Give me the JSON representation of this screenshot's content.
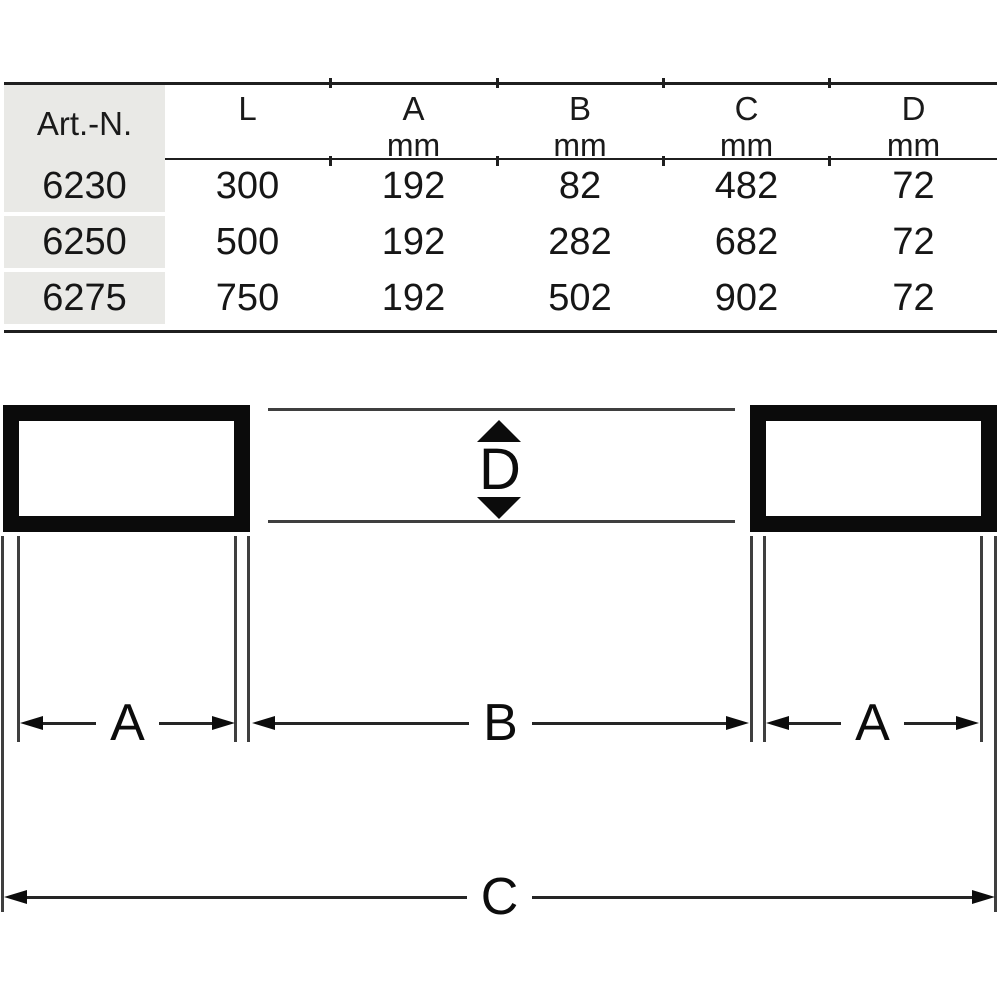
{
  "table": {
    "columns": [
      {
        "label": "Art.-N.",
        "unit": ""
      },
      {
        "label": "L",
        "unit": ""
      },
      {
        "label": "A",
        "unit": "mm"
      },
      {
        "label": "B",
        "unit": "mm"
      },
      {
        "label": "C",
        "unit": "mm"
      },
      {
        "label": "D",
        "unit": "mm"
      }
    ],
    "rows": [
      {
        "cells": [
          "6230",
          "300",
          "192",
          "82",
          "482",
          "72"
        ]
      },
      {
        "cells": [
          "6250",
          "500",
          "192",
          "282",
          "682",
          "72"
        ]
      },
      {
        "cells": [
          "6275",
          "750",
          "192",
          "502",
          "902",
          "72"
        ]
      }
    ]
  },
  "diagram": {
    "dim_d": "D",
    "dim_a_left": "A",
    "dim_b": "B",
    "dim_a_right": "A",
    "dim_c": "C"
  },
  "appearance": {
    "header_column_bg": "#e9e9e6",
    "table_line_color": "#1f1f1f",
    "thin_line_color": "#3f3f3f",
    "shape_color": "#0b0b0b",
    "text_color": "#1a1a1a"
  }
}
